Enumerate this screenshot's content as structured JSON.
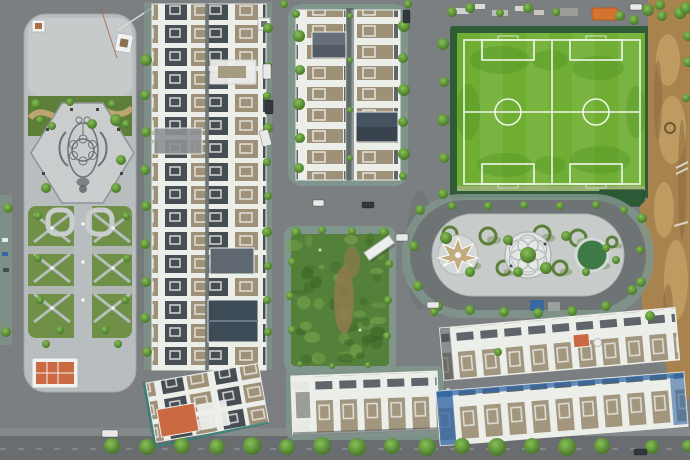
{
  "meta": {
    "description": "Aerial drone view of a new urban residential development: ornamental plaza, rowhouse blocks, twin artificial soccer pitches, oval garden, vacant lot, construction dirt area and tree-lined streets",
    "width": 690,
    "height": 460
  },
  "palette": {
    "road": "#7b7f81",
    "roadDark": "#686c6e",
    "paver": "#80958c",
    "plazaPave": "#b8bdbf",
    "plazaPaveLight": "#c9cdce",
    "mosaic": "#6b7174",
    "hedge": "#5e7f3a",
    "lawn": "#6f9046",
    "pathTan": "#c6aa78",
    "field": "#6fae33",
    "fieldDark": "#4a8a1f",
    "fieldLine": "#eef7ea",
    "fence": "#2f5b36",
    "dirt": "#a8834e",
    "dirtLight": "#cfae70",
    "dirtDark": "#87683c",
    "roofWhite": "#eceeea",
    "roofDark": "#474e53",
    "roofTan": "#9e9178",
    "roofSlate": "#5f6870",
    "roofNavy": "#3d4b57",
    "roofOrange": "#cb6a42",
    "tarpBlue": "#3468a4",
    "teal": "#2f8077",
    "lotGreen": "#55803a",
    "lotDark": "#3d6527",
    "lotLight": "#78a34d",
    "islandPave": "#c7cbca",
    "star": "#c3ab80",
    "greenCircle": "#3e7a45",
    "carWhite": "#e9eae7",
    "carDark": "#33383c",
    "treeDark": "#3f6a24",
    "treeLight": "#86c155",
    "orangeCanopy": "#d4742e"
  },
  "scene": {
    "trees": [
      [
        36,
        104,
        5
      ],
      [
        52,
        126,
        4
      ],
      [
        70,
        102,
        4
      ],
      [
        92,
        124,
        5
      ],
      [
        112,
        104,
        4
      ],
      [
        126,
        124,
        4
      ],
      [
        116,
        120,
        6
      ],
      [
        121,
        160,
        5
      ],
      [
        46,
        188,
        5
      ],
      [
        116,
        188,
        5
      ],
      [
        40,
        120,
        4
      ],
      [
        38,
        216,
        4
      ],
      [
        126,
        216,
        4
      ],
      [
        38,
        258,
        4
      ],
      [
        127,
        258,
        4
      ],
      [
        40,
        300,
        4
      ],
      [
        125,
        300,
        4
      ],
      [
        60,
        330,
        4
      ],
      [
        105,
        330,
        4
      ],
      [
        118,
        344,
        4
      ],
      [
        46,
        344,
        4
      ],
      [
        8,
        208,
        5
      ],
      [
        6,
        332,
        5
      ],
      [
        146,
        60,
        6
      ],
      [
        145,
        95,
        5
      ],
      [
        146,
        132,
        5
      ],
      [
        145,
        170,
        5
      ],
      [
        146,
        206,
        5
      ],
      [
        145,
        244,
        5
      ],
      [
        146,
        282,
        5
      ],
      [
        145,
        318,
        5
      ],
      [
        147,
        352,
        5
      ],
      [
        268,
        28,
        5
      ],
      [
        268,
        66,
        4
      ],
      [
        267,
        96,
        4
      ],
      [
        268,
        128,
        5
      ],
      [
        267,
        162,
        4
      ],
      [
        268,
        196,
        4
      ],
      [
        267,
        232,
        5
      ],
      [
        268,
        266,
        4
      ],
      [
        267,
        300,
        4
      ],
      [
        268,
        332,
        4
      ],
      [
        299,
        36,
        6
      ],
      [
        300,
        70,
        5
      ],
      [
        299,
        104,
        6
      ],
      [
        300,
        138,
        5
      ],
      [
        299,
        168,
        5
      ],
      [
        296,
        14,
        4
      ],
      [
        404,
        26,
        6
      ],
      [
        403,
        58,
        5
      ],
      [
        404,
        90,
        6
      ],
      [
        403,
        122,
        5
      ],
      [
        404,
        154,
        6
      ],
      [
        403,
        176,
        4
      ],
      [
        350,
        16,
        3
      ],
      [
        350,
        60,
        3
      ],
      [
        350,
        110,
        3
      ],
      [
        350,
        158,
        3
      ],
      [
        443,
        44,
        6
      ],
      [
        444,
        82,
        5
      ],
      [
        443,
        120,
        6
      ],
      [
        444,
        158,
        5
      ],
      [
        443,
        194,
        5
      ],
      [
        284,
        4,
        4
      ],
      [
        408,
        4,
        4
      ],
      [
        452,
        12,
        5
      ],
      [
        470,
        8,
        5
      ],
      [
        500,
        13,
        4
      ],
      [
        528,
        8,
        5
      ],
      [
        556,
        12,
        4
      ],
      [
        620,
        16,
        5
      ],
      [
        634,
        20,
        5
      ],
      [
        648,
        10,
        6
      ],
      [
        660,
        5,
        5
      ],
      [
        680,
        13,
        6
      ],
      [
        688,
        36,
        5
      ],
      [
        686,
        8,
        6
      ],
      [
        662,
        16,
        5
      ],
      [
        688,
        62,
        5
      ],
      [
        686,
        98,
        4
      ],
      [
        642,
        218,
        5
      ],
      [
        640,
        250,
        4
      ],
      [
        641,
        282,
        5
      ],
      [
        650,
        316,
        5
      ],
      [
        420,
        210,
        5
      ],
      [
        414,
        246,
        5
      ],
      [
        418,
        286,
        5
      ],
      [
        438,
        306,
        5
      ],
      [
        470,
        310,
        5
      ],
      [
        504,
        312,
        5
      ],
      [
        538,
        313,
        5
      ],
      [
        572,
        311,
        5
      ],
      [
        606,
        306,
        5
      ],
      [
        632,
        290,
        5
      ],
      [
        452,
        206,
        4
      ],
      [
        488,
        206,
        4
      ],
      [
        524,
        205,
        4
      ],
      [
        560,
        206,
        4
      ],
      [
        596,
        205,
        4
      ],
      [
        624,
        210,
        4
      ],
      [
        446,
        238,
        6
      ],
      [
        470,
        272,
        5
      ],
      [
        508,
        240,
        5
      ],
      [
        518,
        272,
        5
      ],
      [
        546,
        268,
        6
      ],
      [
        566,
        236,
        5
      ],
      [
        586,
        272,
        4
      ],
      [
        606,
        248,
        4
      ],
      [
        616,
        260,
        4
      ],
      [
        528,
        255,
        8
      ],
      [
        296,
        232,
        5
      ],
      [
        322,
        230,
        4
      ],
      [
        352,
        231,
        4
      ],
      [
        384,
        232,
        5
      ],
      [
        292,
        262,
        4
      ],
      [
        290,
        296,
        4
      ],
      [
        292,
        330,
        4
      ],
      [
        389,
        264,
        4
      ],
      [
        388,
        300,
        4
      ],
      [
        387,
        336,
        4
      ],
      [
        300,
        364,
        3
      ],
      [
        332,
        366,
        3
      ],
      [
        368,
        365,
        3
      ],
      [
        434,
        312,
        4
      ],
      [
        498,
        352,
        4
      ],
      [
        112,
        446,
        8
      ],
      [
        147,
        447,
        8
      ],
      [
        182,
        446,
        8
      ],
      [
        217,
        447,
        8
      ],
      [
        252,
        446,
        9
      ],
      [
        287,
        447,
        8
      ],
      [
        322,
        446,
        9
      ],
      [
        357,
        447,
        9
      ],
      [
        392,
        446,
        8
      ],
      [
        427,
        447,
        9
      ],
      [
        462,
        446,
        8
      ],
      [
        497,
        447,
        9
      ],
      [
        532,
        446,
        8
      ],
      [
        567,
        447,
        9
      ],
      [
        602,
        446,
        8
      ],
      [
        652,
        447,
        7
      ],
      [
        688,
        446,
        6
      ]
    ],
    "cars": [
      {
        "x": 263,
        "y": 64,
        "w": 8,
        "h": 15,
        "rot": 0,
        "c": "carWhite"
      },
      {
        "x": 265,
        "y": 100,
        "w": 8,
        "h": 14,
        "rot": 0,
        "c": "carDark"
      },
      {
        "x": 261,
        "y": 130,
        "w": 9,
        "h": 16,
        "rot": -15,
        "c": "carWhite"
      },
      {
        "x": 313,
        "y": 200,
        "w": 11,
        "h": 6,
        "rot": 0,
        "c": "carWhite"
      },
      {
        "x": 362,
        "y": 202,
        "w": 12,
        "h": 6,
        "rot": 0,
        "c": "carDark"
      },
      {
        "x": 396,
        "y": 234,
        "w": 12,
        "h": 7,
        "rot": 0,
        "c": "carWhite"
      },
      {
        "x": 427,
        "y": 302,
        "w": 12,
        "h": 6,
        "rot": 0,
        "c": "carWhite"
      },
      {
        "x": 102,
        "y": 430,
        "w": 16,
        "h": 7,
        "rot": 0,
        "c": "carWhite"
      },
      {
        "x": 634,
        "y": 449,
        "w": 13,
        "h": 6,
        "rot": 0,
        "c": "carDark"
      },
      {
        "x": 403,
        "y": 10,
        "w": 7,
        "h": 13,
        "rot": 0,
        "c": "carDark"
      },
      {
        "x": 630,
        "y": 4,
        "w": 12,
        "h": 6,
        "rot": 0,
        "c": "carWhite"
      }
    ],
    "fieldBlobs": [
      [
        500,
        60,
        30,
        14
      ],
      [
        598,
        68,
        26,
        12
      ],
      [
        505,
        165,
        28,
        12
      ],
      [
        600,
        160,
        30,
        14
      ],
      [
        468,
        112,
        12,
        28
      ],
      [
        636,
        112,
        10,
        26
      ],
      [
        550,
        60,
        18,
        10
      ],
      [
        550,
        165,
        16,
        9
      ]
    ],
    "dirtLightBlobs": [
      [
        668,
        60,
        12,
        26
      ],
      [
        672,
        130,
        14,
        34
      ],
      [
        664,
        210,
        10,
        28
      ],
      [
        676,
        280,
        12,
        40
      ],
      [
        664,
        340,
        10,
        22
      ]
    ],
    "dirtDarkBlobs": [
      [
        658,
        100,
        4,
        40
      ],
      [
        682,
        180,
        4,
        60
      ],
      [
        668,
        310,
        5,
        26
      ]
    ],
    "ovalSwirls": [
      [
        450,
        234,
        7
      ],
      [
        468,
        262,
        8
      ],
      [
        488,
        236,
        8
      ],
      [
        504,
        268,
        7
      ],
      [
        542,
        234,
        8
      ],
      [
        560,
        268,
        7
      ],
      [
        578,
        238,
        8
      ],
      [
        598,
        262,
        7
      ],
      [
        612,
        242,
        5
      ]
    ],
    "lotTexture": {
      "count": 46,
      "seed": 7,
      "x": 293,
      "y": 238,
      "w": 92,
      "h": 122
    }
  }
}
